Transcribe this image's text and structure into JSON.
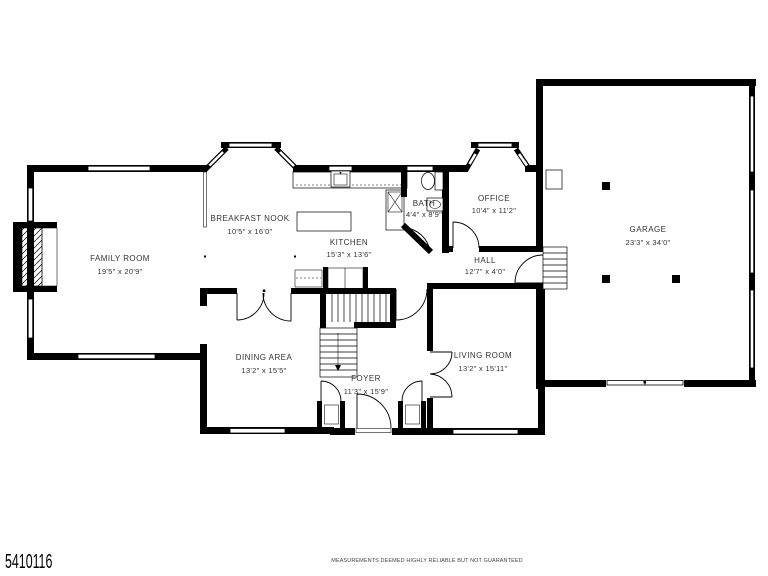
{
  "rooms": [
    {
      "name": "FAMILY ROOM",
      "dims": "19'5\" x 20'9\""
    },
    {
      "name": "BREAKFAST NOOK",
      "dims": "10'5\" x 16'0\""
    },
    {
      "name": "KITCHEN",
      "dims": "15'3\" x 13'6\""
    },
    {
      "name": "BATH",
      "dims": "4'4\" x 8'9\""
    },
    {
      "name": "OFFICE",
      "dims": "10'4\" x 11'2\""
    },
    {
      "name": "HALL",
      "dims": "12'7\" x 4'0\""
    },
    {
      "name": "GARAGE",
      "dims": "23'3\" x 34'0\""
    },
    {
      "name": "DINING AREA",
      "dims": "13'2\" x 15'5\""
    },
    {
      "name": "FOYER",
      "dims": "11'3\" x 15'9\""
    },
    {
      "name": "LIVING ROOM",
      "dims": "13'2\" x 15'11\""
    }
  ],
  "footer": {
    "listing_id": "5410116",
    "disclaimer": "MEASUREMENTS DEEMED HIGHLY RELIABLE BUT NOT GUARANTEED"
  },
  "colors": {
    "wall": "#000000",
    "background": "#ffffff",
    "label": "#333333"
  }
}
